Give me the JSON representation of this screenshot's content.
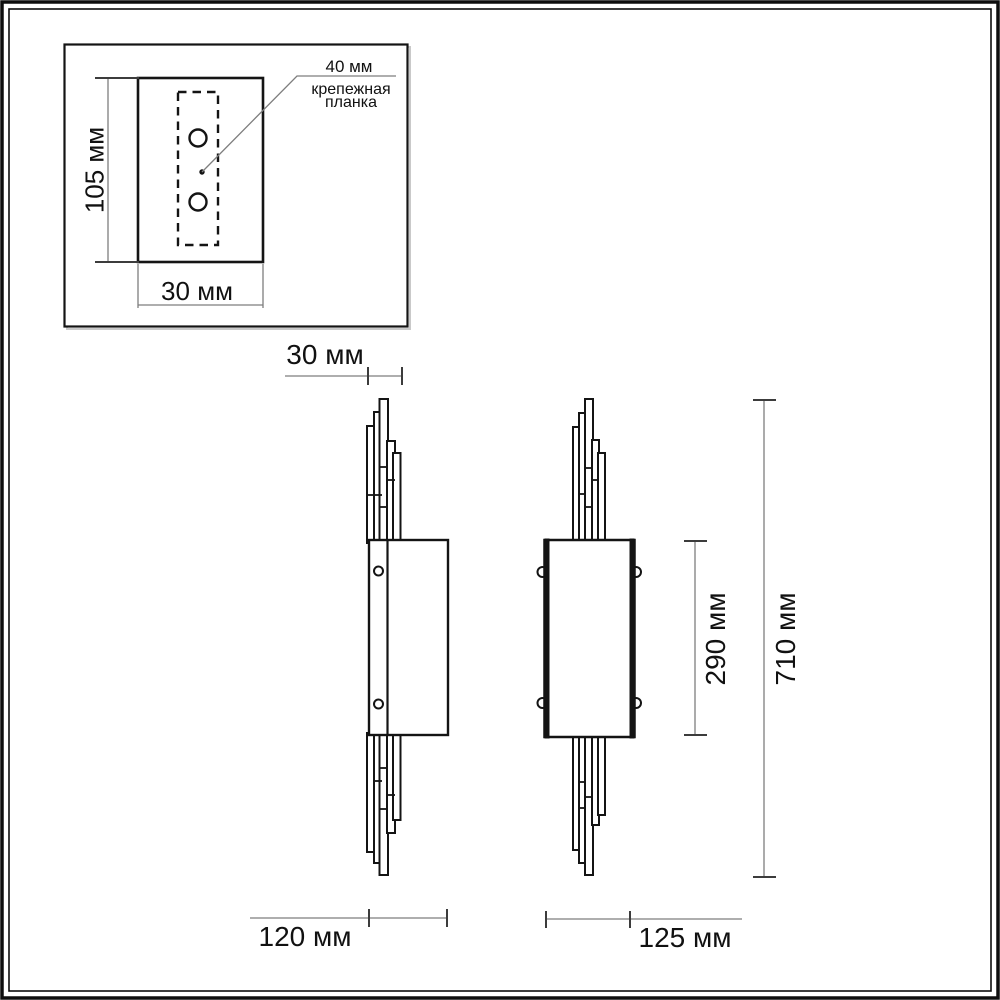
{
  "diagram": {
    "kind": "wall-sconce dimensional drawing",
    "colors": {
      "line": "#141414",
      "dimension_line": "#7e7e7e",
      "background": "#ffffff"
    },
    "inset": {
      "height": "105 мм",
      "width": "30 мм",
      "callout_dim": "40 мм",
      "callout_name_line1": "крепежная",
      "callout_name_line2": "планка"
    },
    "side_view": {
      "slat_depth": "30 мм",
      "depth": "120 мм"
    },
    "front_view": {
      "width": "125 мм",
      "body_height": "290 мм",
      "total_height": "710 мм"
    }
  }
}
